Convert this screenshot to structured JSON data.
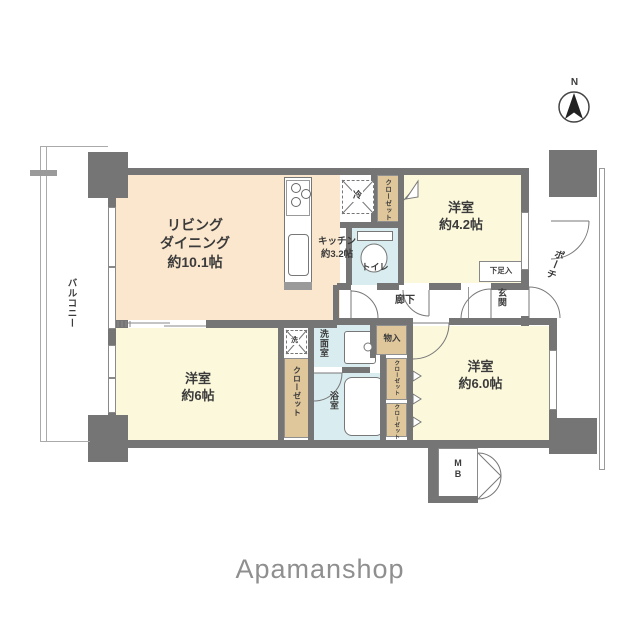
{
  "brand": {
    "name": "Apamanshop"
  },
  "compass": {
    "label": "N"
  },
  "outdoor": {
    "balcony_label": "バルコニー",
    "porch_label": "ポーチ",
    "meter_box_label": "M\nB"
  },
  "rooms": {
    "living_dining": "リビング\nダイニング\n約10.1帖",
    "kitchen": "キッチン\n約3.2帖",
    "bedroom_north": "洋室\n約4.2帖",
    "bedroom_southwest": "洋室\n約6帖",
    "bedroom_southeast": "洋室\n約6.0帖",
    "toilet": "トイレ",
    "hallway": "廊下",
    "entrance": "玄関",
    "washroom": "洗面室",
    "bathroom": "浴室"
  },
  "storage": {
    "closet_north": "クローゼット",
    "closet_southwest": "クローゼット",
    "closet_se_upper": "クローゼット",
    "closet_se_lower": "クローゼット",
    "cupboard": "物入",
    "shoe_cabinet": "下足入"
  },
  "appliances": {
    "refrigerator": "冷",
    "washer": "洗"
  },
  "colors": {
    "wall": "#757575",
    "living_dining": "#fbe7cd",
    "bedroom": "#fcf8dc",
    "wet_area": "#d9ecef",
    "closet": "#dfc79b"
  }
}
